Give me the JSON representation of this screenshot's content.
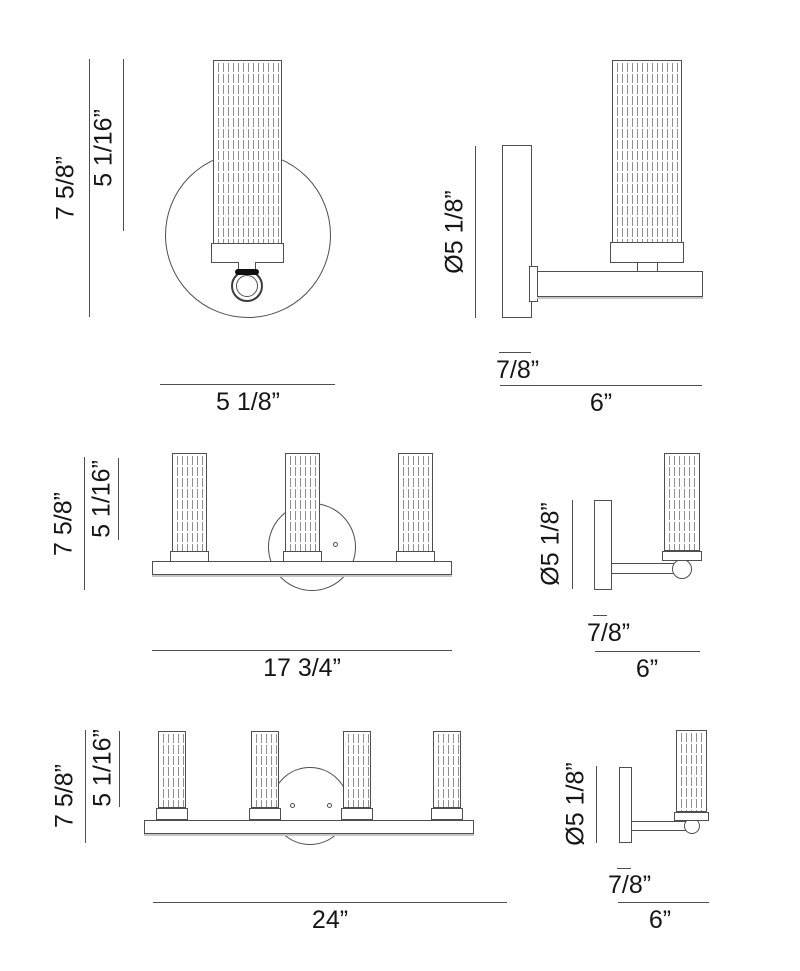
{
  "colors": {
    "background": "#ffffff",
    "line": "#4f4f4f",
    "text": "#161616"
  },
  "views": {
    "one_light_front": {
      "overall_height": "7 5/8”",
      "glass_height": "5 1/16”",
      "overall_width": "5 1/8”"
    },
    "one_light_side": {
      "backplate_diameter": "Ø5 1/8”",
      "backplate_depth": "7/8”",
      "extension": "6”"
    },
    "three_light_front": {
      "overall_height": "7 5/8”",
      "glass_height": "5 1/16”",
      "overall_width": "17 3/4”"
    },
    "three_light_side": {
      "backplate_diameter": "Ø5 1/8”",
      "backplate_depth": "7/8”",
      "extension": "6”"
    },
    "four_light_front": {
      "overall_height": "7 5/8”",
      "glass_height": "5 1/16”",
      "overall_width": "24”"
    },
    "four_light_side": {
      "backplate_diameter": "Ø5 1/8”",
      "backplate_depth": "7/8”",
      "extension": "6”"
    }
  }
}
